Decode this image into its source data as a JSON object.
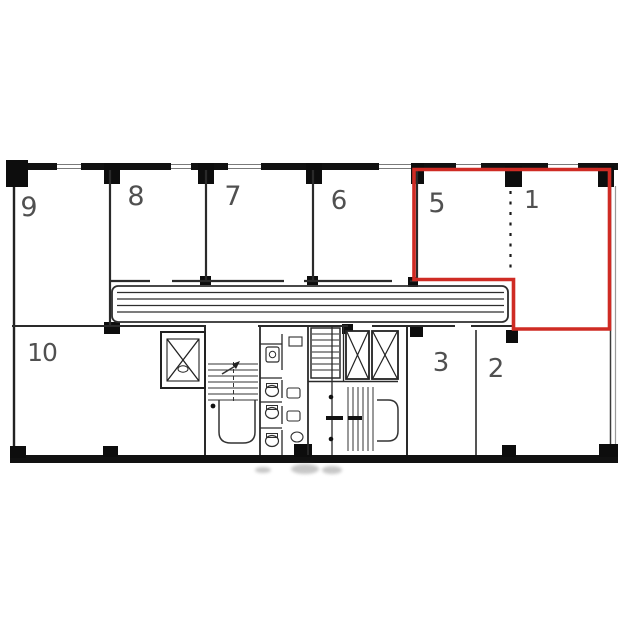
{
  "plan": {
    "type": "building-floor-plan",
    "room_labels": [
      "9",
      "8",
      "7",
      "6",
      "5",
      "1",
      "10",
      "3",
      "2"
    ],
    "highlighted_rooms": [
      "5",
      "1"
    ],
    "highlight_color": "#cf2b24",
    "wall_color": "#111111",
    "icons": [
      "elevator-icon",
      "staircase-icon",
      "toilet-icon",
      "corridor-band",
      "column-marker",
      "dotted-partition"
    ]
  }
}
